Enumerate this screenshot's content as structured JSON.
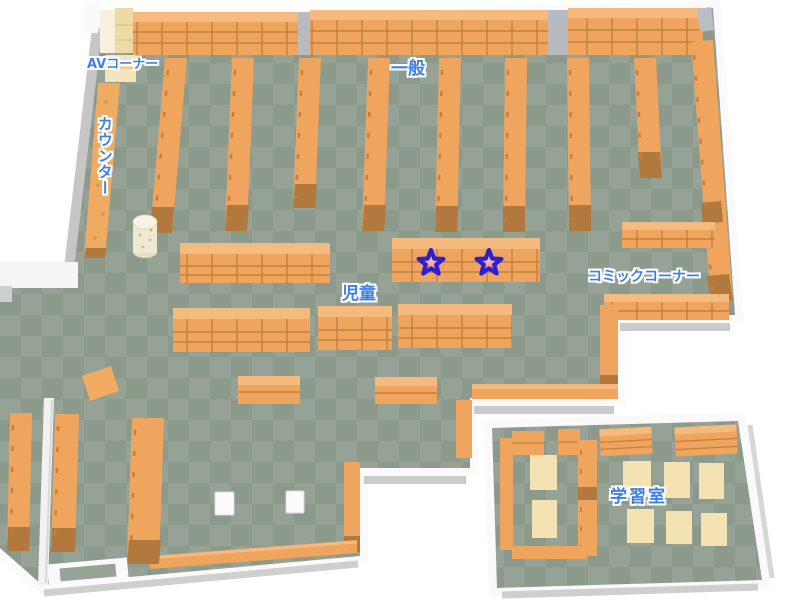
{
  "map": {
    "type": "library-floor-map",
    "areas": [
      {
        "id": "av-corner",
        "label": "AVコーナー"
      },
      {
        "id": "counter",
        "label": "カウンター"
      },
      {
        "id": "general",
        "label": "一般"
      },
      {
        "id": "children",
        "label": "児童"
      },
      {
        "id": "comic-corner",
        "label": "コミックコーナー"
      },
      {
        "id": "study-room",
        "label": "学習室"
      }
    ],
    "markers": [
      {
        "id": "star-1",
        "shape": "star"
      },
      {
        "id": "star-2",
        "shape": "star"
      }
    ],
    "colors": {
      "floor_light": "#95A295",
      "floor_dark": "#8B9A8B",
      "shelf": "#F0A55F",
      "shelf_shadow": "#B2793E",
      "wall": "#FAFAFA",
      "wall_gray": "#C6C6C6",
      "counter": "#EDAC61",
      "desk": "#F5E2B2",
      "av_shelf": "#F3E4BE",
      "label_blue": "#3E7FE8",
      "star_red": "#ED5A5A",
      "star_border": "#2B1FD0"
    }
  }
}
